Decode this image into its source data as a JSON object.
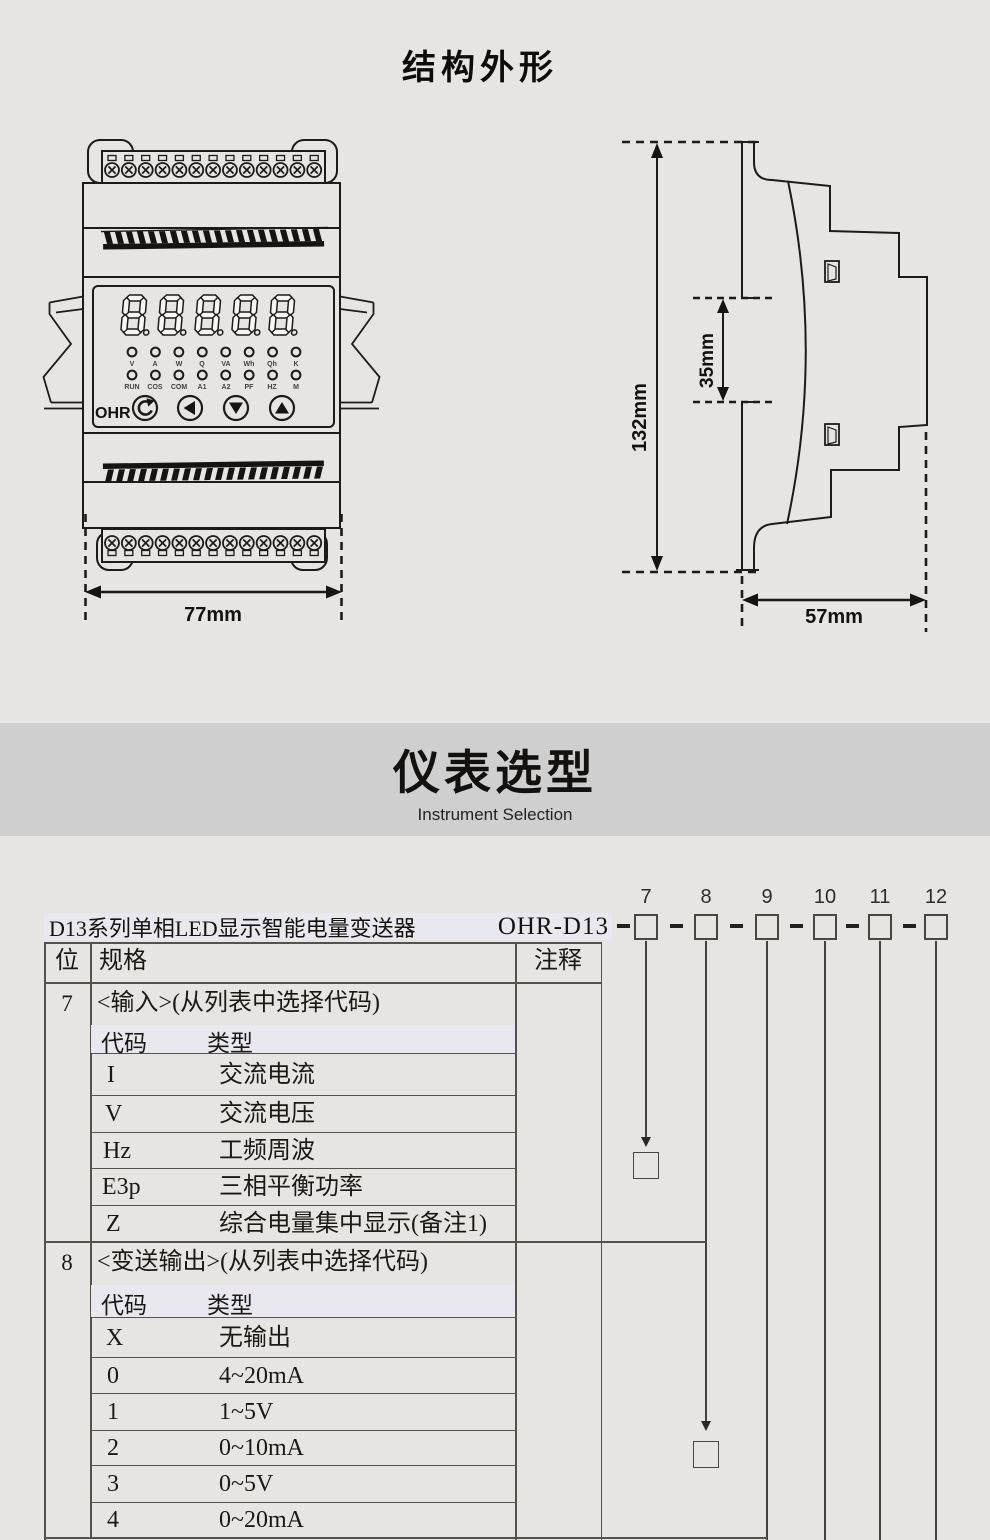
{
  "page": {
    "title_structure": "结构外形",
    "section_title": "仪表选型",
    "section_subtitle": "Instrument Selection"
  },
  "device": {
    "brand": "OHR",
    "leds1": [
      "V",
      "A",
      "W",
      "Q",
      "VA",
      "Wh",
      "Qh",
      "K"
    ],
    "leds2": [
      "RUN",
      "COS",
      "COM",
      "A1",
      "A2",
      "PF",
      "HZ",
      "M"
    ],
    "dim_width": "77mm",
    "dim_height": "132mm",
    "dim_rail": "35mm",
    "dim_depth": "57mm"
  },
  "selection": {
    "product_label": "D13系列单相LED显示智能电量变送器",
    "model_prefix": "OHR-D13",
    "digit_positions": [
      "7",
      "8",
      "9",
      "10",
      "11",
      "12"
    ],
    "table": {
      "headers": {
        "pos": "位",
        "spec": "规格",
        "note": "注释"
      },
      "sections": [
        {
          "pos": "7",
          "title": "<输入>(从列表中选择代码)",
          "col_code": "代码",
          "col_type": "类型",
          "rows": [
            {
              "code": "I",
              "type": "交流电流"
            },
            {
              "code": "V",
              "type": "交流电压"
            },
            {
              "code": "Hz",
              "type": "工频周波"
            },
            {
              "code": "E3p",
              "type": "三相平衡功率"
            },
            {
              "code": "Z",
              "type": "综合电量集中显示(备注1)"
            }
          ]
        },
        {
          "pos": "8",
          "title": "<变送输出>(从列表中选择代码)",
          "col_code": "代码",
          "col_type": "类型",
          "rows": [
            {
              "code": "X",
              "type": "无输出"
            },
            {
              "code": "0",
              "type": "4~20mA"
            },
            {
              "code": "1",
              "type": "1~5V"
            },
            {
              "code": "2",
              "type": "0~10mA"
            },
            {
              "code": "3",
              "type": "0~5V"
            },
            {
              "code": "4",
              "type": "0~20mA"
            }
          ]
        }
      ]
    }
  },
  "colors": {
    "background": "#e7e5e3",
    "band": "#d0cfcf",
    "highlight": "#e9e8ee",
    "line": "#1d1b19"
  }
}
